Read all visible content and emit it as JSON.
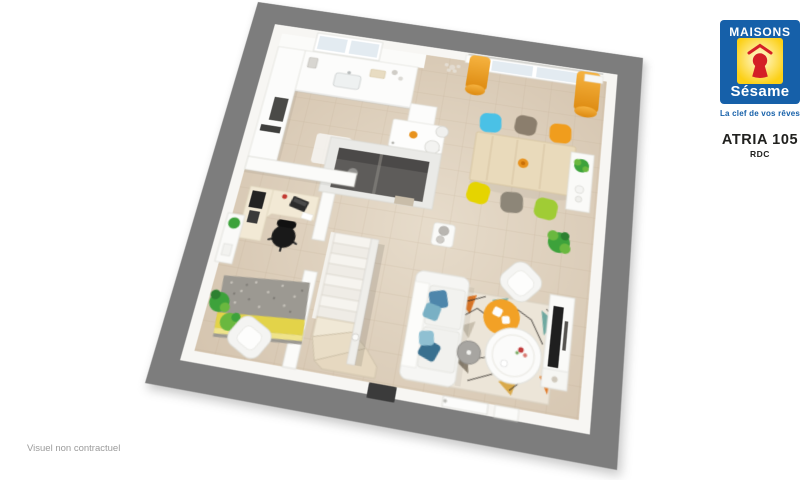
{
  "branding": {
    "logo": {
      "name_top": "MAISONS",
      "name_bottom": "Sésame",
      "tagline": "La clef de vos rêves",
      "colors": {
        "brand_blue": "#1660a9",
        "brand_yellow": "#fcd016",
        "brand_red": "#d41f26"
      }
    },
    "model_name": "ATRIA 105",
    "floor_label": "RDC"
  },
  "footer": {
    "disclaimer": "Visuel non contractuel"
  },
  "floor_plan": {
    "type": "3d-floor-plan",
    "floor_shown": "ground floor (RDC)",
    "rooms_visible": [
      "kitchen",
      "dining-area",
      "living-area",
      "office-bedroom",
      "wc",
      "staircase",
      "entrance-hall"
    ],
    "colors": {
      "frame_gray": "#7d7d7d",
      "wall_white": "#fbfbf9",
      "floor_beige": "#d3c2ac",
      "floor_light": "#e7dccb",
      "tile_line": "#b59f84",
      "curtain_light": "#f6b340",
      "curtain_dark": "#dd8a10",
      "wood_table": "#e9dabb",
      "step_wood": "#e6d8c0",
      "chair_cyan": "#4ac1e6",
      "chair_taupe": "#8b7e6d",
      "chair_orange": "#f09d1d",
      "chair_yellow": "#e5d400",
      "chair_gray": "#8d8678",
      "chair_green": "#a0cc35",
      "plant_green": "#3da23b",
      "plant_light": "#6ab83f",
      "rug_office_gray": "#9c9992",
      "rug_office_yellow": "#e3d349",
      "rug_living_base": "#ece5d8",
      "rug_living_orange": "#e07a2a",
      "rug_living_teal": "#6fa8a0",
      "rug_living_mustard": "#d9a94a",
      "sofa_white": "#f6f6f4",
      "pillow_blue": "#4e86ab",
      "pouf_orange": "#f2a126",
      "tv_dark": "#1f1f1f",
      "wc_dark": "#5e5c5a",
      "mat_dark": "#3b3b3b",
      "bowl_orange": "#e8921c",
      "text_dark": "#20201e",
      "text_gray": "#9b9b9b"
    }
  }
}
